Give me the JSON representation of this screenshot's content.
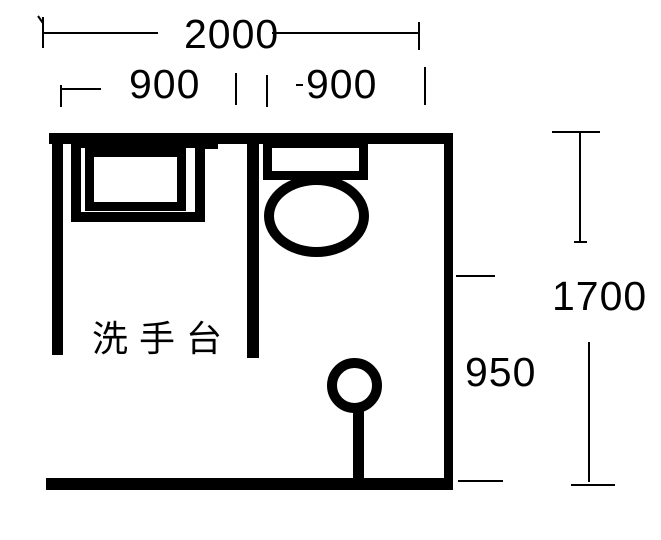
{
  "colors": {
    "ink": "#000000",
    "background": "#ffffff"
  },
  "floor_plan": {
    "room_label": "洗手台",
    "dimensions": {
      "total_width": "2000",
      "left_bay_width": "900",
      "right_bay_width": "900",
      "total_height": "1700",
      "lower_section_height": "950"
    },
    "fixtures": [
      {
        "name": "sink-counter"
      },
      {
        "name": "toilet"
      },
      {
        "name": "shower-head"
      }
    ]
  }
}
